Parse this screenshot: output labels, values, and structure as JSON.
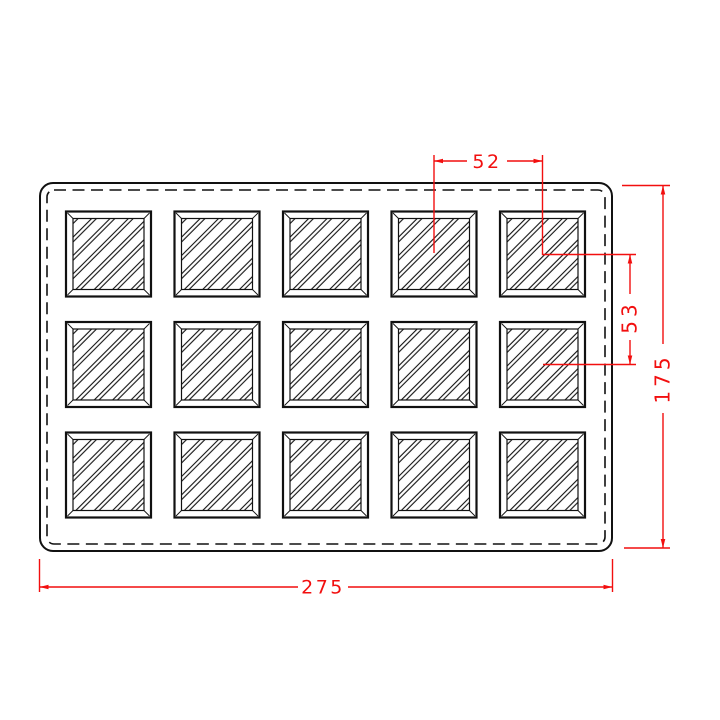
{
  "colors": {
    "line": "#111111",
    "dimension": "#f20f0f",
    "background": "#ffffff"
  },
  "dimensions": {
    "cavity_pitch_x": "52",
    "cavity_pitch_y": "53",
    "overall_height": "175",
    "overall_width": "275"
  },
  "grid": {
    "columns": 5,
    "rows": 3,
    "cavity_count": 15,
    "column_centers_px": [
      108.5,
      217,
      325.5,
      434,
      542.5
    ],
    "row_centers_px": [
      254,
      364.5,
      475
    ],
    "cavity_size_px": 85
  }
}
